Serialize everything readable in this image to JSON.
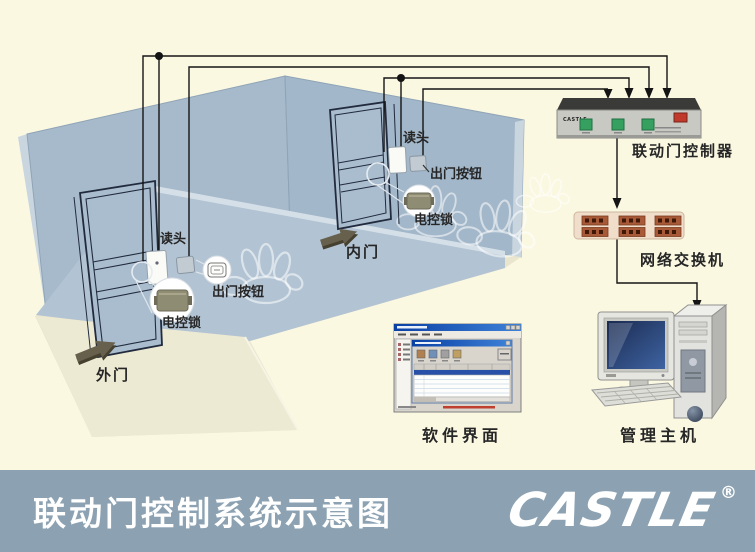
{
  "room": {
    "outer_door": {
      "door_label": "外门",
      "reader_label": "读头",
      "button_label": "出门按钮",
      "lock_label": "电控锁"
    },
    "inner_door": {
      "door_label": "内门",
      "reader_label": "读头",
      "button_label": "出门按钮",
      "lock_label": "电控锁"
    }
  },
  "devices": {
    "controller": {
      "label": "联动门控制器",
      "brand": "CASTLE"
    },
    "network_switch": {
      "label": "网络交换机"
    },
    "software": {
      "label": "软件界面"
    },
    "host": {
      "label": "管理主机"
    }
  },
  "footer": {
    "title": "联动门控制系统示意图",
    "brand": "CASTLE",
    "registered": "®"
  },
  "colors": {
    "background": "#FBF8E2",
    "wall": "#A6BACB",
    "wall_edge": "#CBD8E2",
    "partition": "#B2C3D3",
    "floor": "#EAE6CE",
    "bar": "#8CA2B2",
    "wire": "#141414",
    "button_green": "#35A060",
    "switch_red": "#C0392B",
    "port_brown": "#A85A38"
  }
}
